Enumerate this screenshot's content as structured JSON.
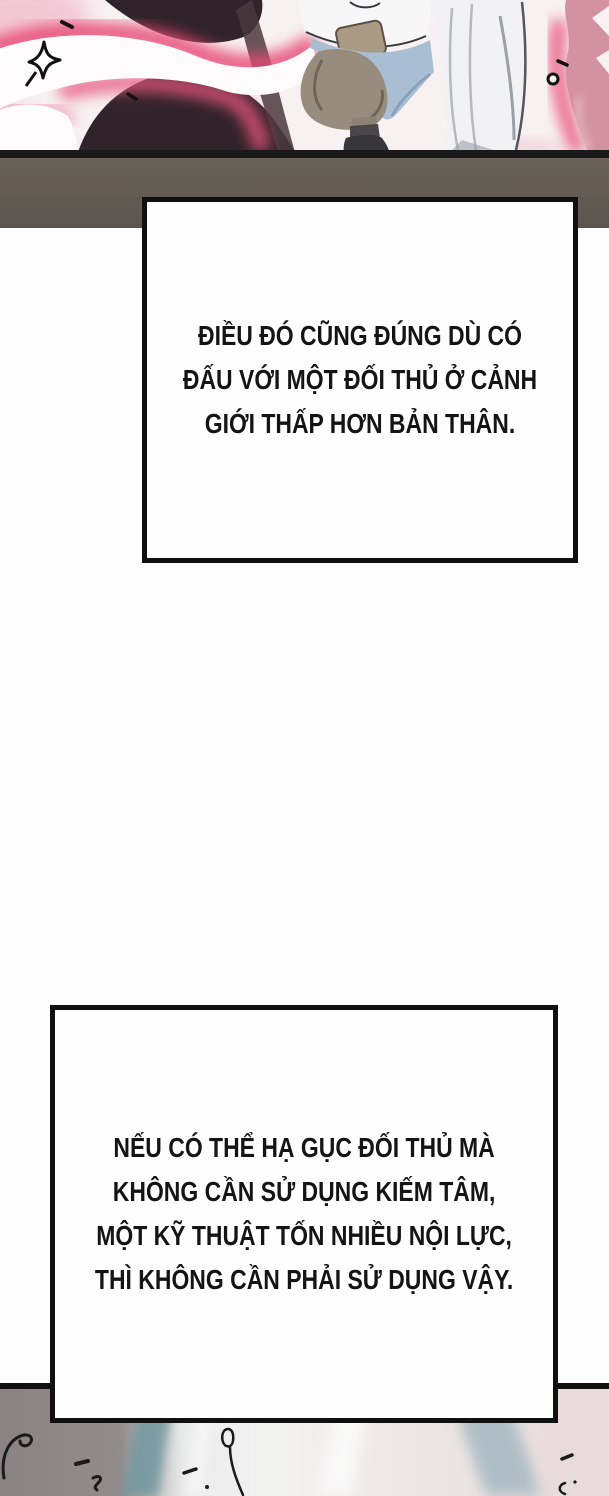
{
  "page": {
    "type": "webtoon-comic-page",
    "background": "#fdfdfd"
  },
  "caption_boxes": [
    {
      "lines": [
        "ĐIỀU ĐÓ CŨNG ĐÚNG DÙ CÓ",
        "ĐẤU VỚI MỘT ĐỐI THỦ Ở CẢNH",
        "GIỚI THẤP HƠN BẢN THÂN."
      ]
    },
    {
      "lines": [
        "NẾU CÓ THỂ HẠ GỤC ĐỐI THỦ MÀ",
        "KHÔNG CẦN SỬ DỤNG KIẾM TÂM,",
        "MỘT KỸ THUẬT TỐN NHIỀU NỘI LỰC,",
        "THÌ KHÔNG CẦN PHẢI SỬ DỤNG VẬY."
      ]
    }
  ],
  "colors": {
    "caption_border": "#101010",
    "caption_fill": "#fefefe",
    "caption_text": "#141414",
    "glow_pink_hot": "#e84876",
    "glow_pink_soft": "#f4afc2",
    "flame_fill": "#d392a1",
    "silhouette_dark": "#31232a",
    "ground_line": "#191919",
    "panel_band": "#5f5852",
    "top_panel_bg": "#f7f1f2",
    "robe_white": "#f2f2f4",
    "pants_taupe": "#988c7e",
    "sash_blue": "#a9bed2",
    "boot_dark": "#37363a",
    "bottom_left_gray": "#8a8283",
    "bottom_teal_streak": "#6f989f",
    "bottom_slate_streak": "#9fb6bd",
    "bottom_pink_right": "#e8dcdc",
    "ink": "#1a1a1a"
  }
}
